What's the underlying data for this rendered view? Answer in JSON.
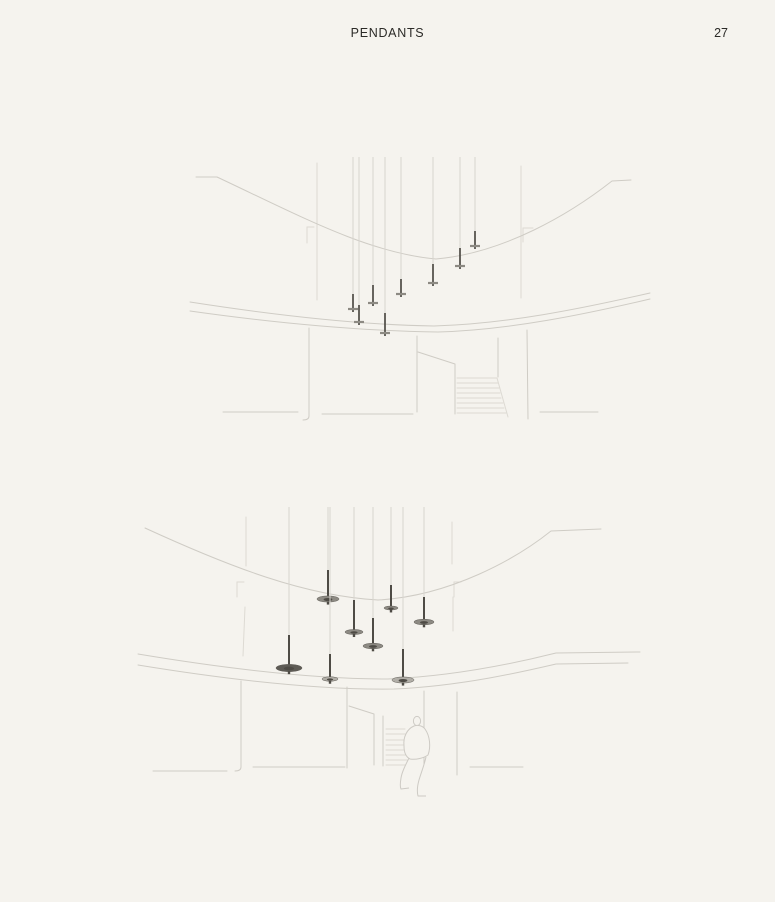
{
  "header": {
    "title": "PENDANTS",
    "page_number": "27"
  },
  "colors": {
    "bg": "#f5f3ee",
    "text": "#2b2a27",
    "line": "#cfccc5",
    "line_light": "#dddad3",
    "cord": "#d8d5cf",
    "rod": "#4e4b45",
    "disc_mid": "#8d8a83",
    "disc_dark": "#5e5b55",
    "disc_light": "#b1aea7",
    "figure": "#cdcac4"
  },
  "sketch_far": {
    "cord_top": 157,
    "disc_half_width": 5,
    "pendants": [
      {
        "x": 353,
        "disc_y": 309,
        "rod": 15
      },
      {
        "x": 359,
        "disc_y": 322,
        "rod": 17
      },
      {
        "x": 373,
        "disc_y": 303,
        "rod": 18
      },
      {
        "x": 385,
        "disc_y": 333,
        "rod": 20
      },
      {
        "x": 401,
        "disc_y": 294,
        "rod": 15
      },
      {
        "x": 433,
        "disc_y": 283,
        "rod": 19
      },
      {
        "x": 460,
        "disc_y": 266,
        "rod": 18
      },
      {
        "x": 475,
        "disc_y": 246,
        "rod": 15
      }
    ]
  },
  "sketch_near": {
    "cord_top": 507,
    "pendants": [
      {
        "x": 328,
        "disc_y": 599,
        "rod": 29,
        "rx": 11,
        "shade": "mid"
      },
      {
        "x": 354,
        "disc_y": 632,
        "rod": 32,
        "rx": 9,
        "shade": "mid"
      },
      {
        "x": 373,
        "disc_y": 646,
        "rod": 28,
        "rx": 10,
        "shade": "mid"
      },
      {
        "x": 391,
        "disc_y": 608,
        "rod": 23,
        "rx": 7,
        "shade": "mid"
      },
      {
        "x": 424,
        "disc_y": 622,
        "rod": 25,
        "rx": 10,
        "shade": "mid"
      },
      {
        "x": 289,
        "disc_y": 668,
        "rod": 33,
        "rx": 13,
        "shade": "dark"
      },
      {
        "x": 330,
        "disc_y": 679,
        "rod": 25,
        "rx": 8,
        "shade": "light"
      },
      {
        "x": 403,
        "disc_y": 680,
        "rod": 31,
        "rx": 11,
        "shade": "light"
      }
    ]
  }
}
